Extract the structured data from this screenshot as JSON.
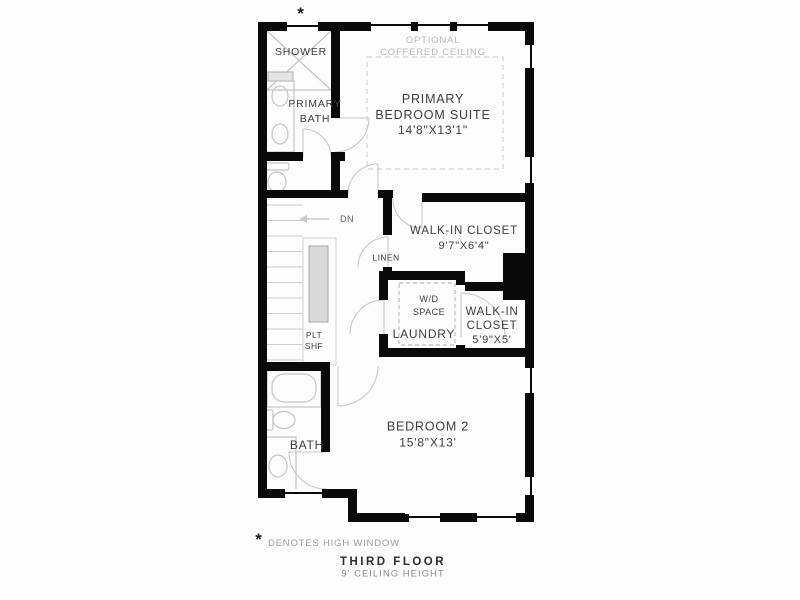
{
  "plan": {
    "high_window_mark": "*",
    "rooms": {
      "shower": {
        "label": "SHOWER"
      },
      "primary_bath": {
        "line1": "PRIMARY",
        "line2": "BATH"
      },
      "primary_bedroom": {
        "note_line1": "OPTIONAL",
        "note_line2": "COFFERED CEILING",
        "name_line1": "PRIMARY",
        "name_line2": "BEDROOM SUITE",
        "dims": "14'8\"X13'1\""
      },
      "walk_in_closet_1": {
        "name": "WALK-IN CLOSET",
        "dims": "9'7\"X6'4\""
      },
      "linen": {
        "label": "LINEN"
      },
      "laundry": {
        "label": "LAUNDRY",
        "wd_line1": "W/D",
        "wd_line2": "SPACE"
      },
      "walk_in_closet_2": {
        "name_line1": "WALK-IN",
        "name_line2": "CLOSET",
        "dims": "5'9\"X5'"
      },
      "bath": {
        "label": "BATH"
      },
      "bedroom_2": {
        "name": "BEDROOM 2",
        "dims": "15'8\"X13'"
      },
      "stairs": {
        "down_label": "DN",
        "shelf_line1": "PLT",
        "shelf_line2": "SHF"
      }
    },
    "legend": {
      "mark": "*",
      "note": "DENOTES HIGH WINDOW"
    },
    "title_block": {
      "title": "THIRD FLOOR",
      "subtitle": "9' CEILING HEIGHT"
    },
    "colors": {
      "wall": "#0a0a0a",
      "fixture": "#c4c4c4",
      "muted": "#b9b9b9",
      "text": "#3c3c3c"
    }
  }
}
